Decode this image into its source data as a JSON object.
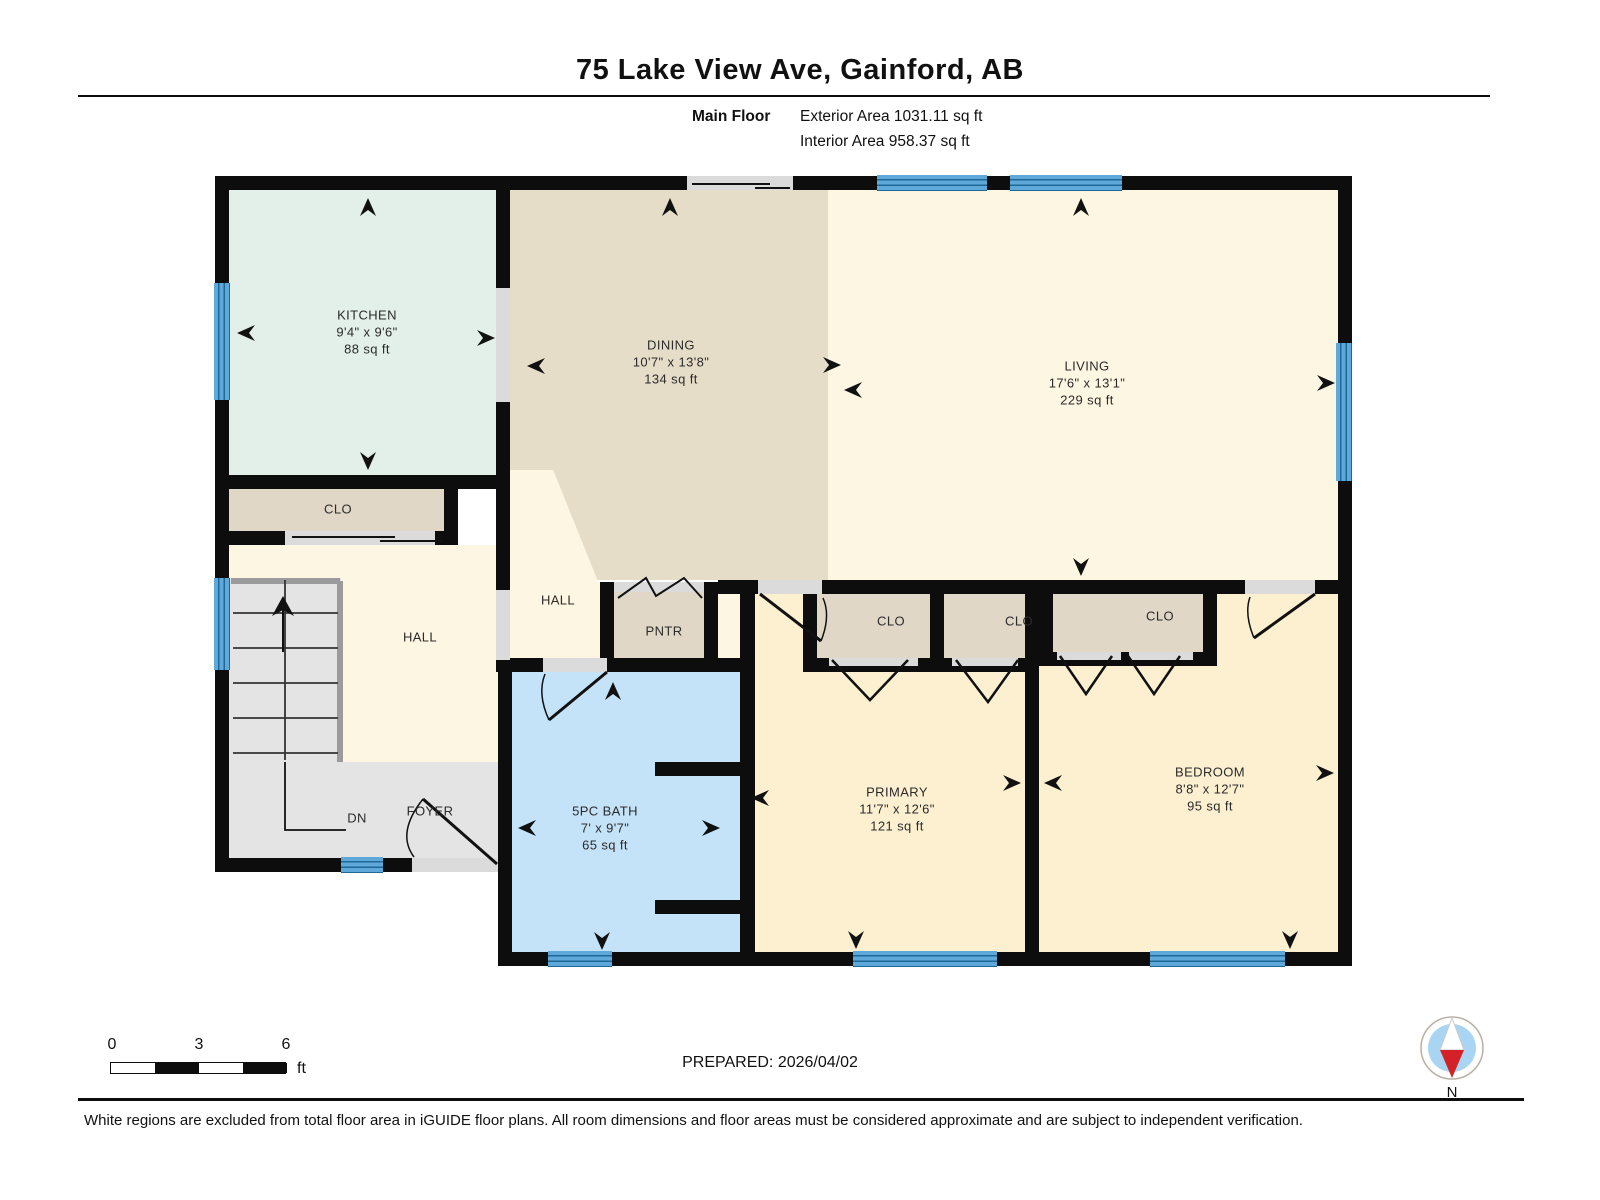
{
  "page": {
    "title": "75 Lake View Ave, Gainford, AB"
  },
  "floor_info": {
    "floor_name": "Main Floor",
    "exterior_area": "Exterior Area 1031.11 sq ft",
    "interior_area": "Interior Area 958.37 sq ft"
  },
  "rooms": {
    "kitchen": {
      "name": "KITCHEN",
      "dims": "9'4\" x 9'6\"",
      "area": "88 sq ft"
    },
    "dining": {
      "name": "DINING",
      "dims": "10'7\" x 13'8\"",
      "area": "134 sq ft"
    },
    "living": {
      "name": "LIVING",
      "dims": "17'6\" x 13'1\"",
      "area": "229 sq ft"
    },
    "bath": {
      "name": "5PC BATH",
      "dims": "7' x 9'7\"",
      "area": "65 sq ft"
    },
    "primary": {
      "name": "PRIMARY",
      "dims": "11'7\" x 12'6\"",
      "area": "121 sq ft"
    },
    "bedroom": {
      "name": "BEDROOM",
      "dims": "8'8\" x 12'7\"",
      "area": "95 sq ft"
    },
    "closet_hall": {
      "name": "CLO"
    },
    "closet_primary_1": {
      "name": "CLO"
    },
    "closet_primary_2": {
      "name": "CLO"
    },
    "closet_bedroom": {
      "name": "CLO"
    },
    "hall_left": {
      "name": "HALL"
    },
    "hall_mid": {
      "name": "HALL"
    },
    "pantry": {
      "name": "PNTR"
    },
    "foyer": {
      "name": "FOYER"
    },
    "stairs": {
      "down_label": "DN"
    }
  },
  "scale_bar": {
    "tick_0": "0",
    "tick_1": "3",
    "tick_2": "6",
    "unit": "ft"
  },
  "footer": {
    "prepared": "PREPARED: 2026/04/02",
    "disclaimer": "White regions are excluded from total floor area in iGUIDE floor plans. All room dimensions and floor areas must be considered approximate and are subject to independent verification."
  },
  "compass": {
    "north_label": "N"
  },
  "colors": {
    "wall": "#0d0d0d",
    "window_blue": "#5ea9d9",
    "kitchen_fill": "#e3efe9",
    "dining_fill": "#e6ddc9",
    "living_fill": "#fdf6e2",
    "bedroom_fill": "#fcf0d1",
    "bath_fill": "#c5e3f8",
    "closet_fill": "#e0d7c6",
    "gray_floor": "#e4e4e4",
    "compass_needle_red": "#d42127"
  }
}
